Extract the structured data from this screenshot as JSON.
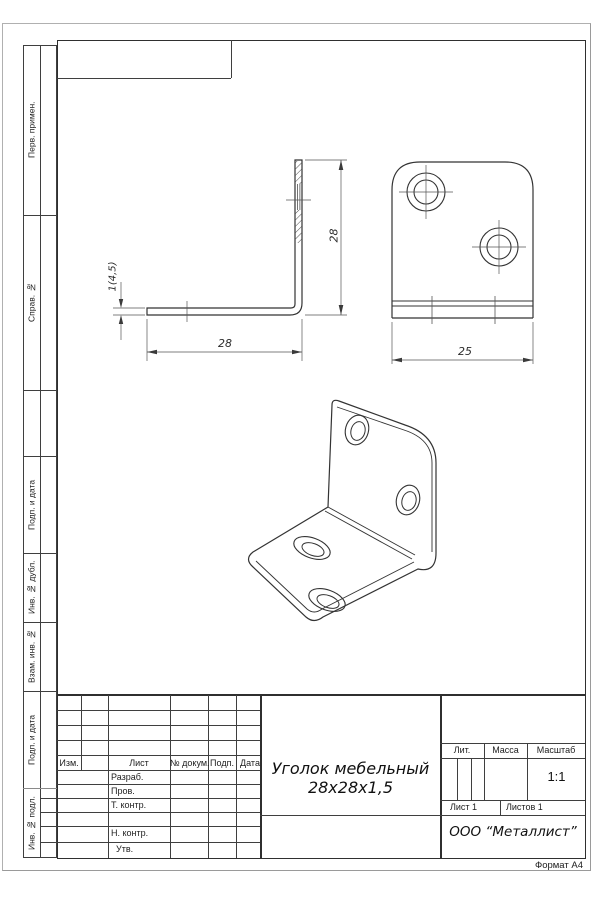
{
  "page": {
    "format_label": "Формат А4"
  },
  "left_strip": {
    "boxes": [
      {
        "label": "Перв. примен."
      },
      {
        "label": "Справ. №"
      },
      {
        "label": "Подп. и дата"
      },
      {
        "label": "Инв. № дубл."
      },
      {
        "label": "Взам. инв. №"
      },
      {
        "label": "Подп. и дата"
      },
      {
        "label": "Инв. № подл."
      }
    ]
  },
  "title_block": {
    "change_header": {
      "izm": "Изм.",
      "list": "Лист",
      "doc": "№ докум.",
      "podp": "Подп.",
      "data": "Дата"
    },
    "roles": {
      "razrab": "Разраб.",
      "prov": "Пров.",
      "tkontr": "Т. контр.",
      "nkontr": "Н. контр.",
      "utv": "Утв."
    },
    "title_line1": "Уголок мебельный",
    "title_line2": "28х28х1,5",
    "lit_label": "Лит.",
    "mass_label": "Масса",
    "scale_label": "Масштаб",
    "scale_value": "1:1",
    "sheet_info": "Лист 1",
    "sheets_info": "Листов 1",
    "company": "ООО “Металлист”"
  },
  "drawing": {
    "side_view": {
      "width_dim": "28",
      "height_dim": "28",
      "thickness_dim": "1(4,5)"
    },
    "front_view": {
      "width_dim": "25"
    }
  }
}
